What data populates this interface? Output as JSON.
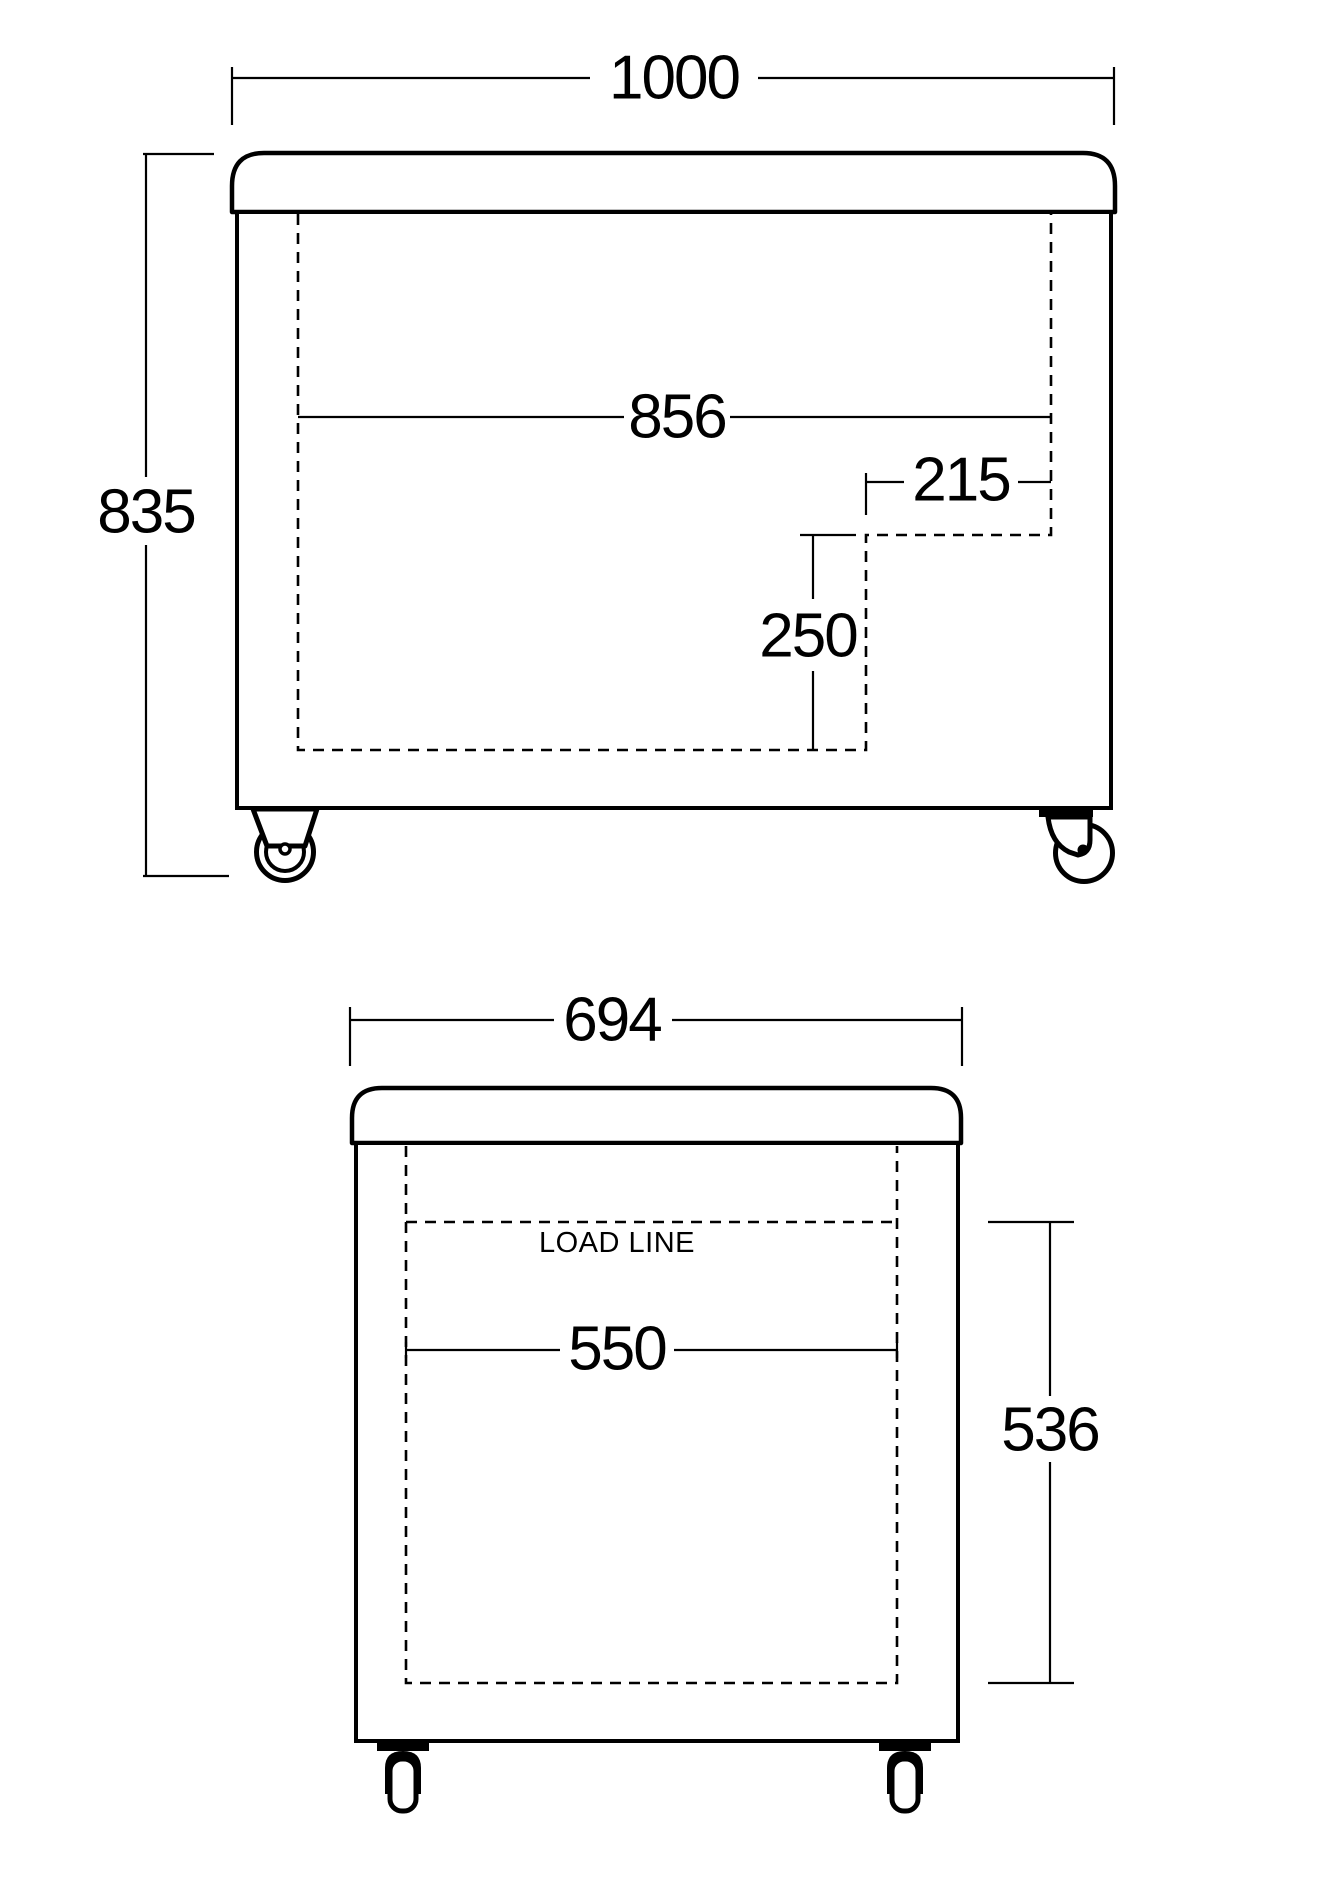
{
  "diagram": {
    "front_view": {
      "width_label": "1000",
      "height_label": "835",
      "inner_width_label": "856",
      "notch_width_label": "215",
      "notch_height_label": "250"
    },
    "side_view": {
      "width_label": "694",
      "load_line_label": "LOAD LINE",
      "inner_width_label": "550",
      "inner_height_label": "536"
    },
    "colors": {
      "line": "#000000",
      "background": "#ffffff"
    }
  }
}
